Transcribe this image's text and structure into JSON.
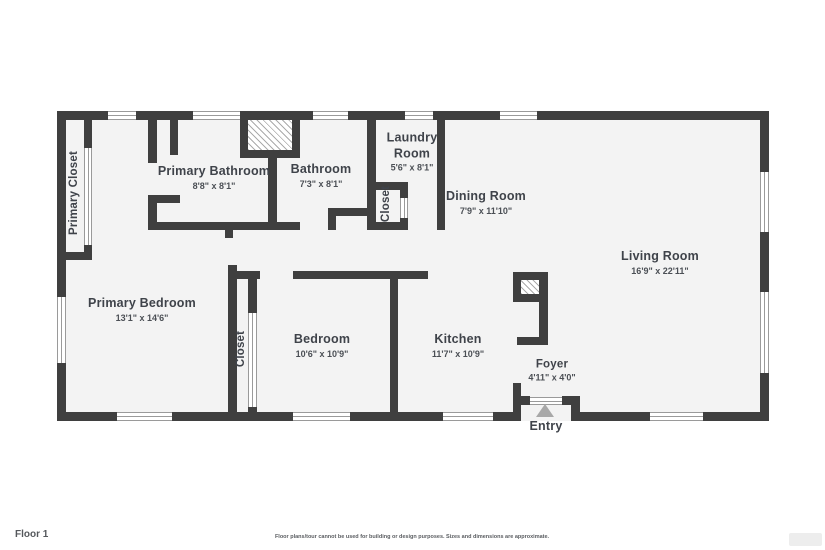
{
  "rooms": {
    "primary_closet": {
      "name": "Primary Closet"
    },
    "primary_bathroom": {
      "name": "Primary Bathroom",
      "dims": "8'8\" x 8'1\""
    },
    "bathroom": {
      "name": "Bathroom",
      "dims": "7'3\" x 8'1\""
    },
    "laundry_room": {
      "name": "Laundry Room",
      "dims": "5'6\" x 8'1\""
    },
    "hall_closet": {
      "name": "Closet"
    },
    "dining_room": {
      "name": "Dining Room",
      "dims": "7'9\" x 11'10\""
    },
    "living_room": {
      "name": "Living Room",
      "dims": "16'9\" x 22'11\""
    },
    "primary_bedroom": {
      "name": "Primary Bedroom",
      "dims": "13'1\" x 14'6\""
    },
    "bedroom_closet": {
      "name": "Closet"
    },
    "bedroom": {
      "name": "Bedroom",
      "dims": "10'6\" x 10'9\""
    },
    "kitchen": {
      "name": "Kitchen",
      "dims": "11'7\" x 10'9\""
    },
    "foyer": {
      "name": "Foyer",
      "dims": "4'11\" x 4'0\""
    },
    "entry": {
      "name": "Entry"
    }
  },
  "footer": {
    "floor_label": "Floor 1",
    "disclaimer": "Floor plans/tour cannot be used for building or design purposes. Sizes and dimensions are approximate."
  },
  "colors": {
    "wall": "#3f3f3f",
    "floor": "#f3f3f3",
    "label": "#3f434a",
    "entry_arrow": "#a8a8a8"
  }
}
